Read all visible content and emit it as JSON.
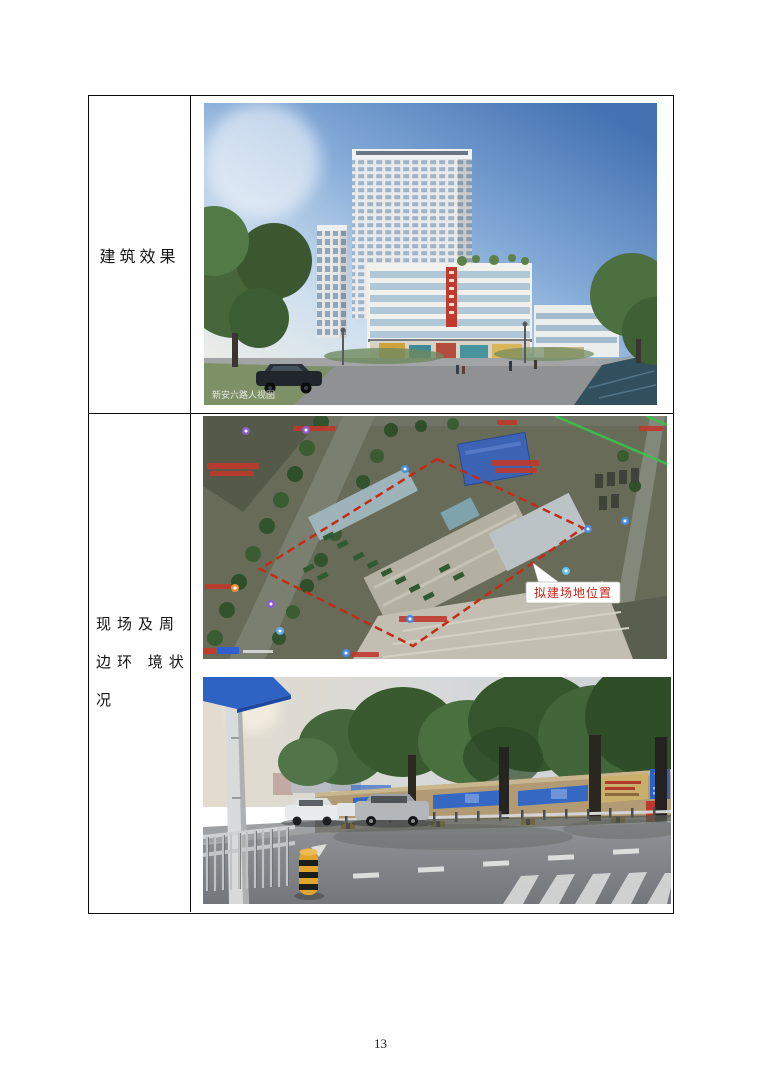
{
  "page": {
    "number": "13"
  },
  "table": {
    "row1": {
      "label": "建筑效果"
    },
    "row2": {
      "label_lines": [
        "现场及周",
        "边环 境状",
        "况"
      ]
    }
  },
  "building_rendering": {
    "watermark": "新安六路人视图"
  },
  "site_map": {
    "callout_label": "拟建场地位置",
    "boundary_color": "#c22b18"
  }
}
